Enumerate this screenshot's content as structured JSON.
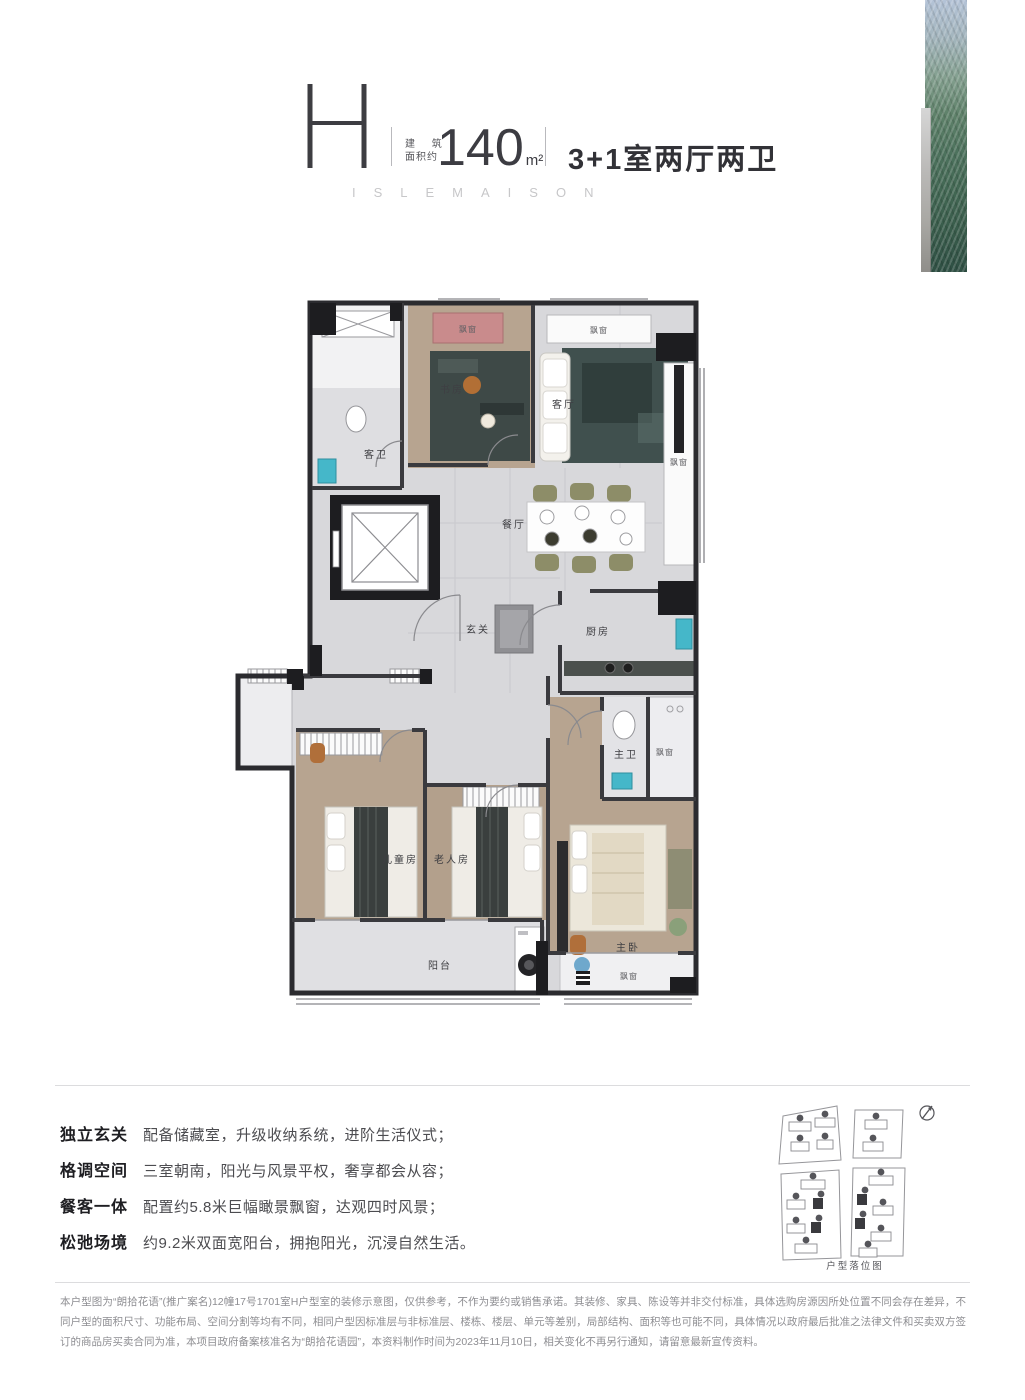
{
  "header": {
    "plan_letter": "H",
    "area_label_line1": "建 筑",
    "area_label_line2": "面积约",
    "area_value": "140",
    "area_unit": "m²",
    "layout": "3+1室两厅两卫",
    "brand": "ISLEMAISON"
  },
  "floorplan": {
    "rooms": {
      "study": "书房",
      "living": "客厅",
      "dining": "餐厅",
      "foyer": "玄关",
      "kitchen": "厨房",
      "guest_bath": "客卫",
      "master_bath": "主卫",
      "kids_room": "儿童房",
      "elder_room": "老人房",
      "master_bedroom": "主卧",
      "balcony": "阳台",
      "bay_window": "飘窗"
    }
  },
  "features": [
    {
      "label": "独立玄关",
      "desc": "配备储藏室，升级收纳系统，进阶生活仪式；"
    },
    {
      "label": "格调空间",
      "desc": "三室朝南，阳光与风景平权，奢享都会从容；"
    },
    {
      "label": "餐客一体",
      "desc": "配置约5.8米巨幅瞰景飘窗，达观四时风景；"
    },
    {
      "label": "松弛场境",
      "desc": "约9.2米双面宽阳台，拥抱阳光，沉浸自然生活。"
    }
  ],
  "siteplan": {
    "caption": "户型落位图"
  },
  "disclaimer": "本户型图为“朗拾花语”(推广案名)12幢17号1701室H户型室的装修示意图，仅供参考，不作为要约或销售承诺。其装修、家具、陈设等并非交付标准，具体选购房源因所处位置不同会存在差异，不同户型的面积尺寸、功能布局、空间分割等均有不同，相同户型因标准层与非标准层、楼栋、楼层、单元等差别，局部结构、面积等也可能不同，具体情况以政府最后批准之法律文件和买卖双方签订的商品房买卖合同为准，本项目政府备案核准名为“朗拾花语园”，本资料制作时间为2023年11月10日，相关变化不再另行通知，请留意最新宣传资料。",
  "colors": {
    "accent_pink_bay": "#c98b8c",
    "teal_fixture": "#45b7c9",
    "wall": "#2b2b2f",
    "wood_floor": "#b7a490",
    "marble_floor": "#d8d8db",
    "rug_dark": "#3e4947",
    "glass_art_green": "#4d725d"
  }
}
